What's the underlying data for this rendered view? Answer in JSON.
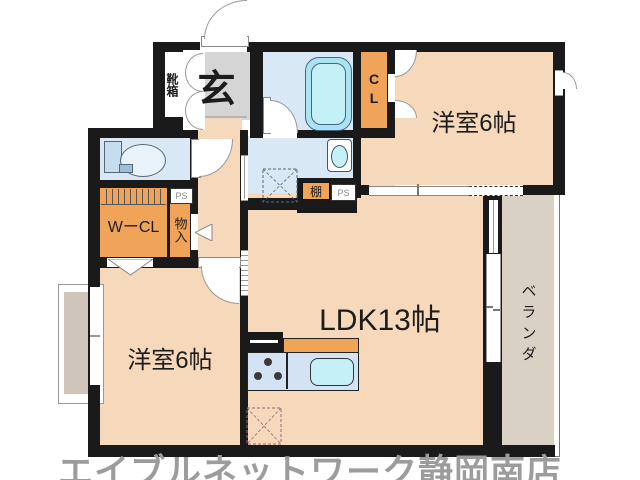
{
  "palette": {
    "wall": "#1a1a1a",
    "floor": "#F6D8BA",
    "accent_orange": "#F0A45A",
    "genkan_gray": "#D5D5D5",
    "water_blue": "#D9E8F5",
    "tub_cyan": "#ABE4F0",
    "fixture_cyan": "#C4F0F8",
    "counter_blue": "#D3E3F4",
    "veranda_beige": "#DAD1C5",
    "footer_gray": "#9C9C9C"
  },
  "labels": {
    "genkan": "玄",
    "shoebox": "靴箱",
    "closet": "CL",
    "walk_in_closet": "WーCL",
    "storage": "物入",
    "shelf": "棚",
    "pipe_space": "PS",
    "bedroom_top": "洋室6帖",
    "bedroom_bottom": "洋室6帖",
    "ldk": "LDK13帖",
    "veranda": "ベランダ"
  },
  "footer": {
    "store_name": "エイブルネットワーク静岡南店"
  }
}
